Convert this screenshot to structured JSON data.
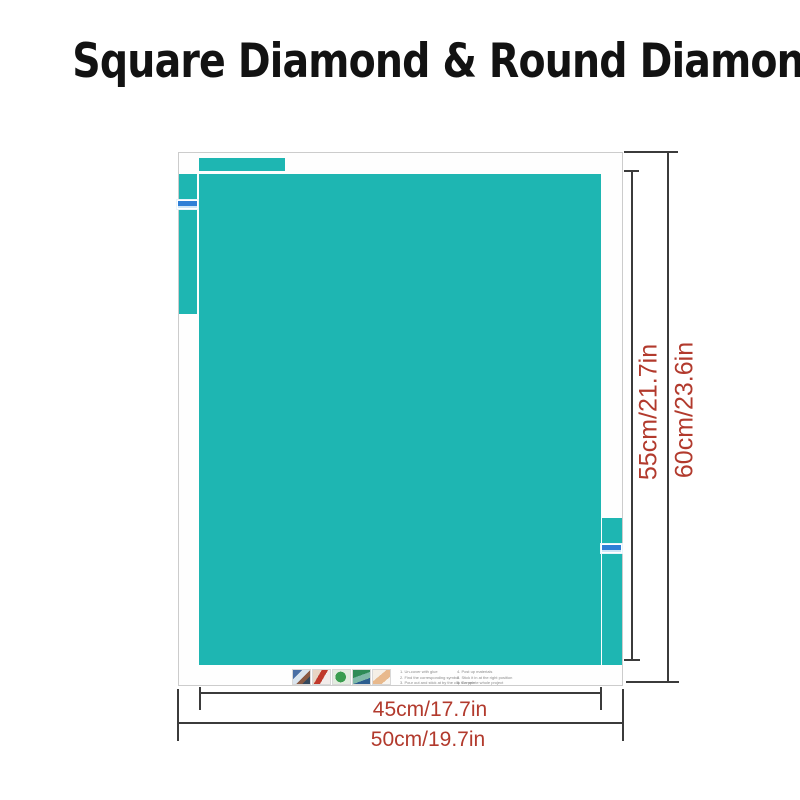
{
  "title": {
    "text": "Square Diamond & Round Diamond"
  },
  "colors": {
    "canvas_teal": "#1eb6b2",
    "dimension_text_red": "#b23a2d",
    "dimension_line": "#3b3b3b",
    "sheet_border": "#cccccc",
    "sticker_blue": "#2f7fd6"
  },
  "measurements": {
    "inner_height_label": "55cm/21.7in",
    "outer_height_label": "60cm/23.6in",
    "inner_width_label": "45cm/17.7in",
    "outer_width_label": "50cm/19.7in"
  },
  "instructions": {
    "left_column": [
      "1. Un-cover with glue",
      "2. Find the corresponding symbol",
      "3. Pour out and stick at by the clip the pen"
    ],
    "right_column": [
      "4. Post up materials",
      "5. Stick it in at the right position",
      "6. Complete whole project"
    ],
    "thumbnails": [
      "step-photo-1",
      "step-photo-2",
      "step-photo-3",
      "step-photo-4",
      "step-photo-5"
    ]
  },
  "stickers": {
    "left": "size-barcode-label",
    "right": "size-barcode-label"
  }
}
